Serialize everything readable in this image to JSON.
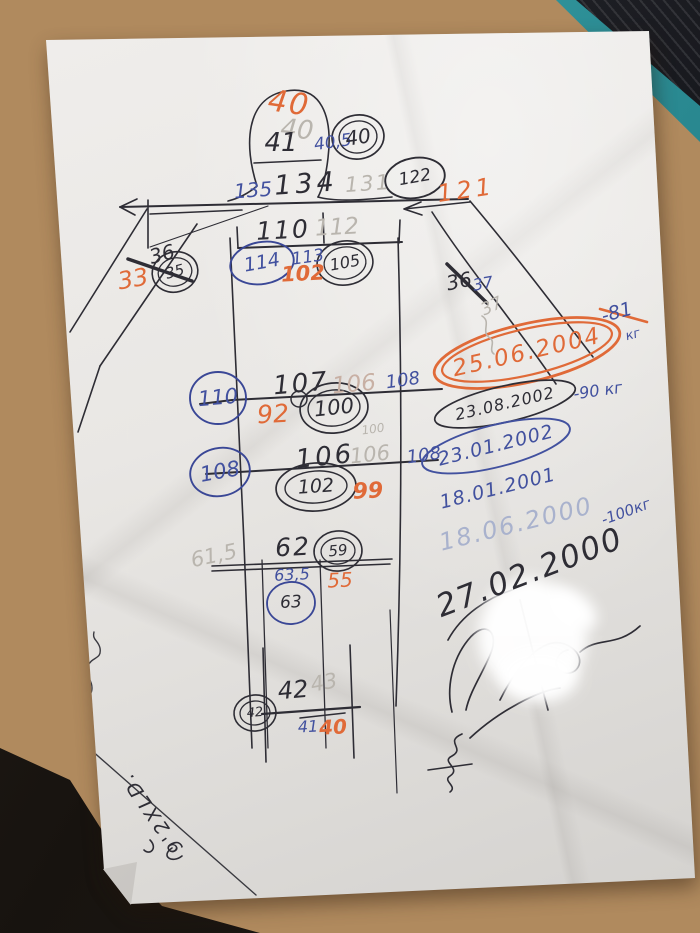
{
  "palette": {
    "ink_black": "#2e2d35",
    "ink_blue": "#42519f",
    "ink_orange": "#e06a38",
    "ink_ghost": "#b9b5ae",
    "ink_ghost_warm": "#c8b0a4",
    "ink_ghost_blue": "#a9b2cd",
    "paper": "#e9e7e4",
    "wood": "#b08a5e",
    "object_teal": "#2f949b",
    "object_black": "#16171b"
  },
  "measurements": {
    "head": {
      "orange": "40",
      "ghost": "40",
      "black": "41",
      "blue": "40,5",
      "circled": "40"
    },
    "shoulders": {
      "blue": "135",
      "black": "134",
      "ghost": "131",
      "circled": "122",
      "orange": "121"
    },
    "left_arm": {
      "black": "36",
      "orange": "33",
      "circled": "35"
    },
    "chest": {
      "black": "110",
      "ghost": "112",
      "circled_left": "114",
      "blue": "113",
      "orange": "102",
      "circled_right": "105"
    },
    "right_arm": {
      "black": "36",
      "blue": "37",
      "ghost": "37"
    },
    "waist": {
      "circled_left": "110",
      "black": "107",
      "ghost": "106",
      "blue": "108",
      "orange": "92",
      "circled_mid": "100",
      "ghost_small": "100"
    },
    "hips": {
      "circled_left": "108",
      "black": "106",
      "ghost": "106",
      "blue": "108",
      "circled_mid": "102",
      "orange": "99"
    },
    "thigh": {
      "ghost": "61,5",
      "black": "62",
      "circled_right": "59",
      "blue": "63,5",
      "orange": "55",
      "circled_below": "63"
    },
    "ankle": {
      "black": "42",
      "ghost": "43",
      "circled_left": "42",
      "blue": "41",
      "orange": "40"
    }
  },
  "weight_log": [
    {
      "date": "25.06.2004",
      "weight": "-81",
      "unit": "кг",
      "style": "orange-circled"
    },
    {
      "date": "23.08.2002",
      "weight": "-90 кг",
      "style": "black-circled"
    },
    {
      "date": "23.01.2002",
      "style": "blue-circled"
    },
    {
      "date": "18.01.2001",
      "style": "blue"
    },
    {
      "date": "18.06.2000",
      "style": "faint-pencil"
    },
    {
      "date": "27.02.2000",
      "weight": "-100кг",
      "style": "large-black"
    }
  ],
  "corner_note": "9'2XLD."
}
